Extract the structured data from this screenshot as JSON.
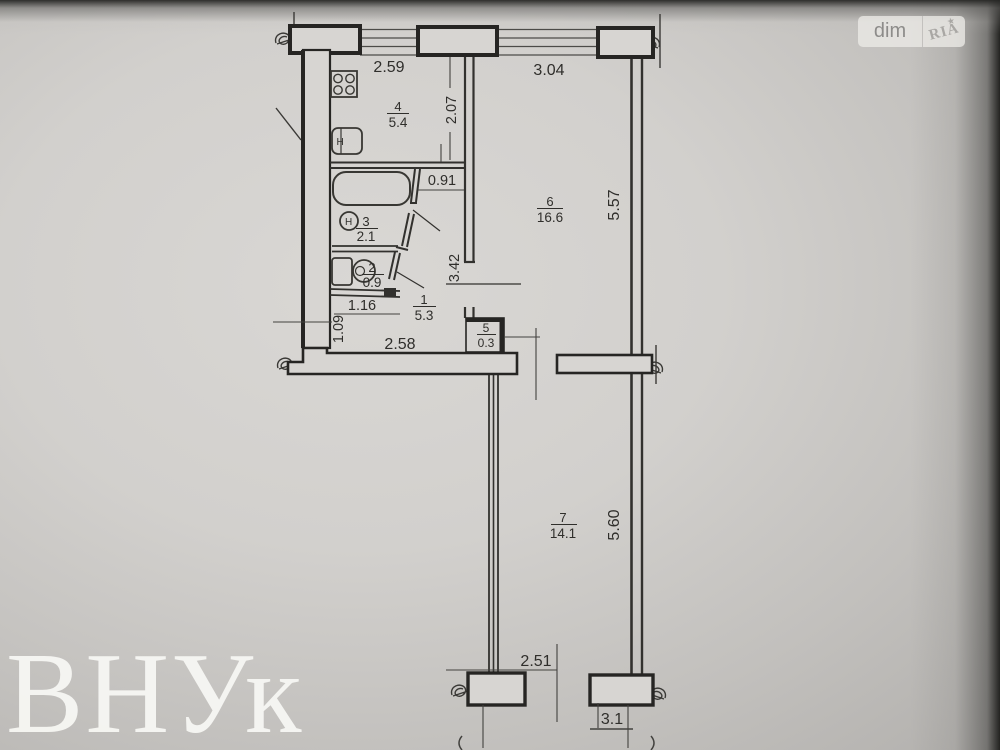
{
  "plan": {
    "rooms": {
      "kitchen": {
        "num": "4",
        "area": "5.4"
      },
      "bath": {
        "num": "3",
        "area": "2.1"
      },
      "wc": {
        "num": "2",
        "area": "0.9"
      },
      "hall": {
        "num": "1",
        "area": "5.3"
      },
      "closet": {
        "num": "5",
        "area": "0.3"
      },
      "living": {
        "num": "6",
        "area": "16.6"
      },
      "bedroom": {
        "num": "7",
        "area": "14.1"
      }
    },
    "dims": {
      "window_left": "2.59",
      "window_right": "3.04",
      "kitchen_depth": "2.07",
      "kitchen_door": "0.91",
      "hall_depth": "3.42",
      "living_depth": "5.57",
      "wc_width": "1.16",
      "hall_offset": "1.09",
      "hall_width": "2.58",
      "bedroom_depth": "5.60",
      "balcony_span": "2.51",
      "balcony_width": "3.1"
    },
    "fixtures": {
      "tap_label": "H"
    }
  },
  "overlay": {
    "watermark": "ВНУк",
    "logo_left": "dim",
    "logo_right": "RIA",
    "logo_star": "★"
  }
}
